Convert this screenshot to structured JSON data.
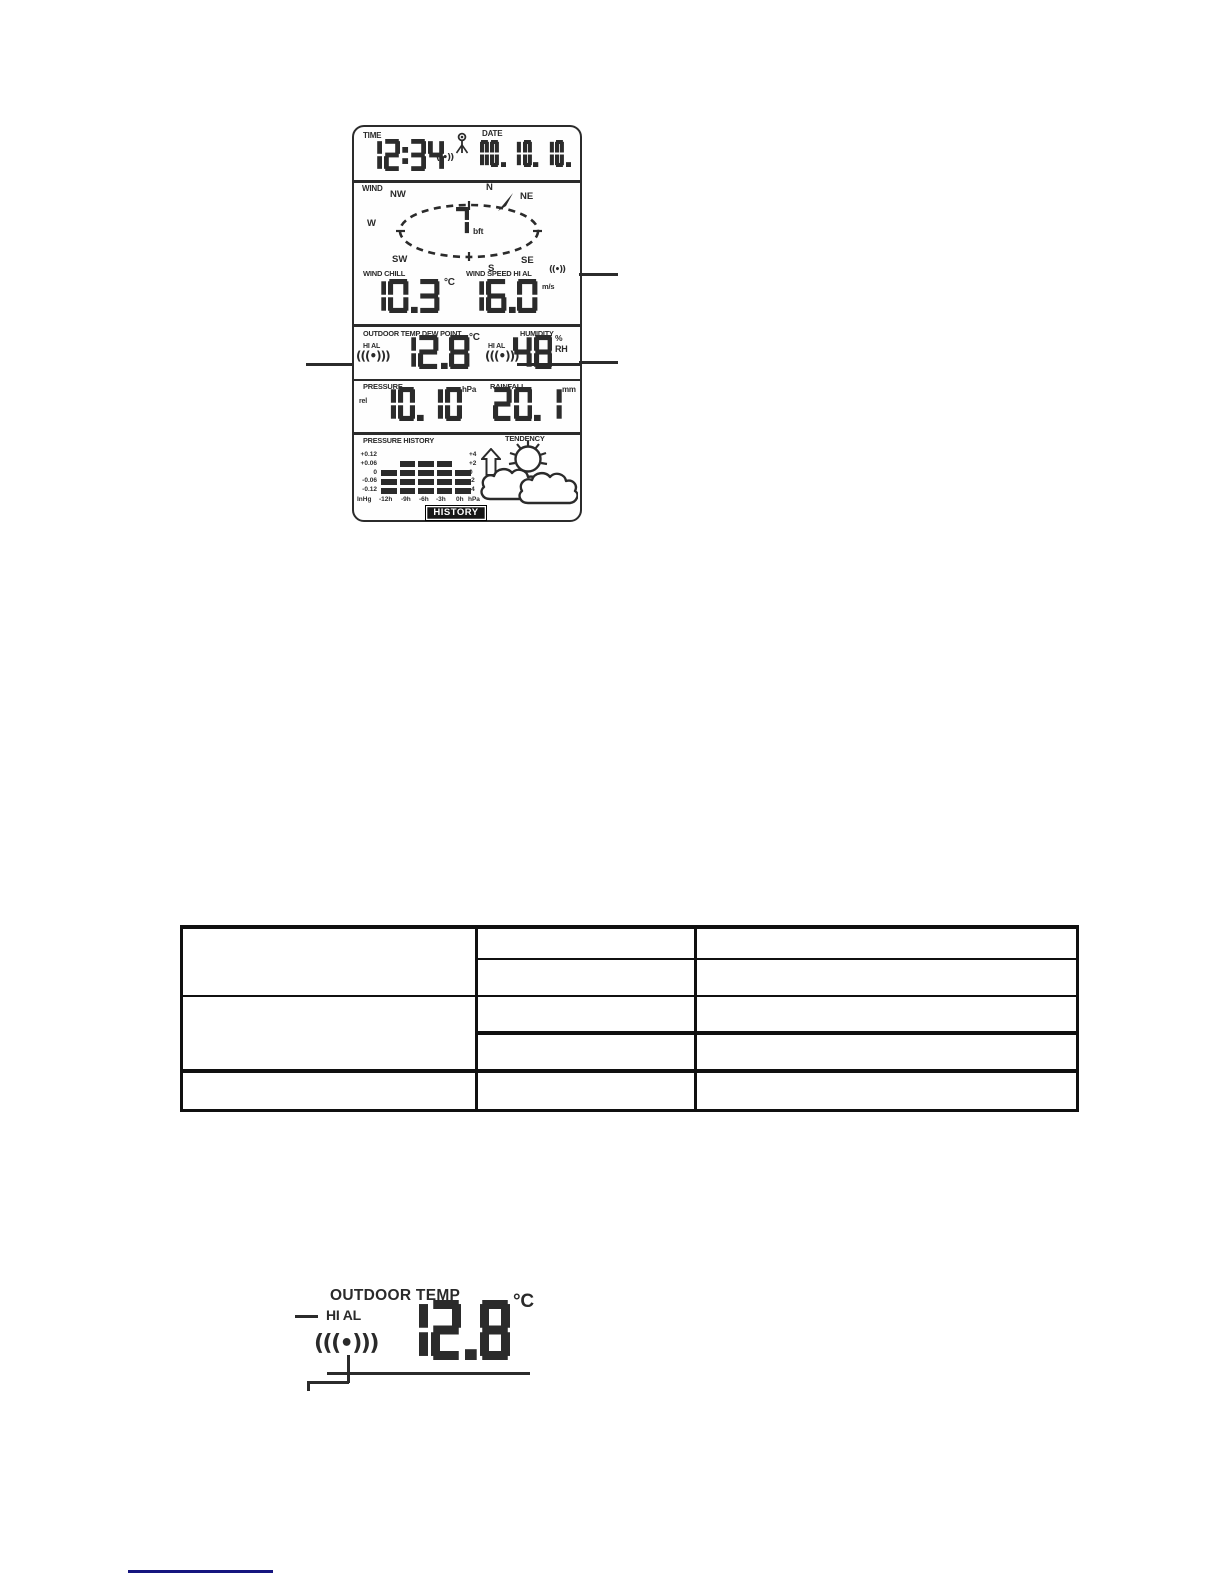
{
  "figure_lcd": {
    "time": {
      "label": "TIME",
      "value": "12:34"
    },
    "date": {
      "label": "DATE",
      "value": "MO. 10. 10."
    },
    "signal_time": "((•))",
    "wind": {
      "label": "WIND",
      "dirs": {
        "n": "N",
        "ne": "NE",
        "se": "SE",
        "s": "S",
        "sw": "SW",
        "w": "W",
        "nw": "NW"
      },
      "value": "7",
      "unit": "bft"
    },
    "wind_chill": {
      "label": "WIND CHILL",
      "value": "10.3",
      "unit": "°C"
    },
    "wind_speed": {
      "label": "WIND SPEED HI AL",
      "signal": "((•))",
      "value": "16.0",
      "unit": "m/s"
    },
    "outdoor": {
      "label": "OUTDOOR TEMP DEW POINT",
      "hi_al": "HI AL",
      "signal": "(((•)))",
      "value": "12.8",
      "unit": "°C"
    },
    "humidity": {
      "label": "HUMIDITY",
      "hi_al": "HI AL",
      "signal": "(((•)))",
      "value": "48",
      "unit_top": "%",
      "unit_bottom": "RH"
    },
    "pressure": {
      "label": "PRESSURE",
      "prefix": "rel",
      "value": "10.10",
      "unit": "hPa"
    },
    "rainfall": {
      "label": "RAINFALL",
      "value": "20.1",
      "unit": "mm"
    },
    "pressure_history": {
      "label": "PRESSURE HISTORY",
      "button": "HISTORY",
      "left_axis": [
        "+0.12",
        "+0.06",
        "0",
        "-0.06",
        "-0.12"
      ],
      "right_axis": [
        "+4",
        "+2",
        "0",
        "-2",
        "-4"
      ],
      "x_axis": [
        "InHg",
        "-12h",
        "-9h",
        "-6h",
        "-3h",
        "0h",
        "hPa"
      ],
      "bar_matrix": [
        [
          0,
          0,
          0,
          0,
          0
        ],
        [
          0,
          1,
          1,
          1,
          0
        ],
        [
          1,
          1,
          1,
          1,
          1
        ],
        [
          1,
          1,
          1,
          1,
          1
        ],
        [
          1,
          1,
          1,
          1,
          1
        ]
      ]
    },
    "tendency": {
      "label": "TENDENCY"
    }
  },
  "spec_table": {
    "cells": [
      [
        "",
        "",
        ""
      ],
      [
        "",
        ""
      ],
      [
        "",
        "",
        ""
      ],
      [
        "",
        ""
      ],
      [
        "",
        "",
        ""
      ]
    ]
  },
  "figure_outdoor": {
    "title": "OUTDOOR TEMP",
    "hi_al": "HI AL",
    "signal": "(((•)))",
    "value": "12.8",
    "unit": "°C"
  },
  "colors": {
    "ink": "#2b2b2b",
    "table_border": "#101010",
    "footer_link": "#16167f"
  }
}
